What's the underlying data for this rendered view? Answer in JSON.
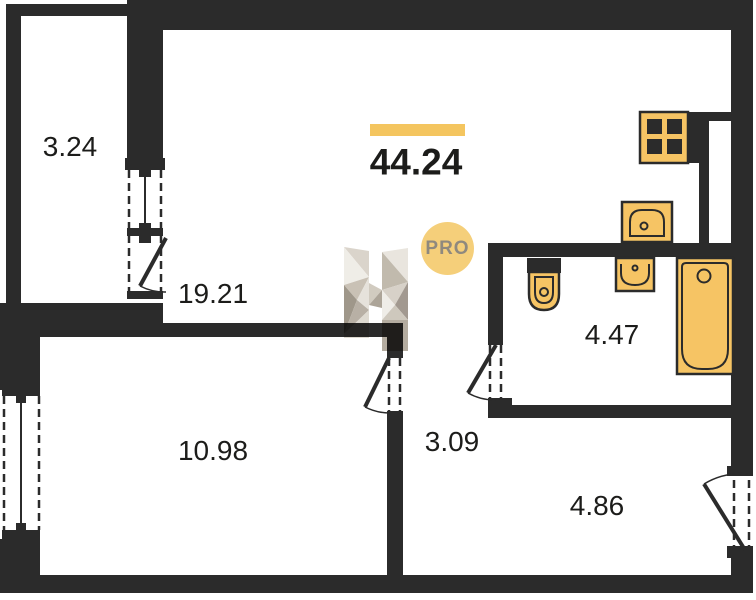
{
  "total": {
    "area": "44.24"
  },
  "rooms": {
    "balcony": "3.24",
    "living_kitchen": "19.21",
    "bedroom": "10.98",
    "hallway": "3.09",
    "bathroom": "4.47",
    "entry": "4.86"
  },
  "watermark": {
    "badge": "PRO"
  },
  "colors": {
    "wall": "#2b2b2b",
    "fixture": "#f6c464",
    "accent_bar": "#f4c55f",
    "badge_bg": "#f5cf7a",
    "badge_text": "#8f897e",
    "label_text": "#1c1c1a",
    "background": "#ffffff"
  }
}
